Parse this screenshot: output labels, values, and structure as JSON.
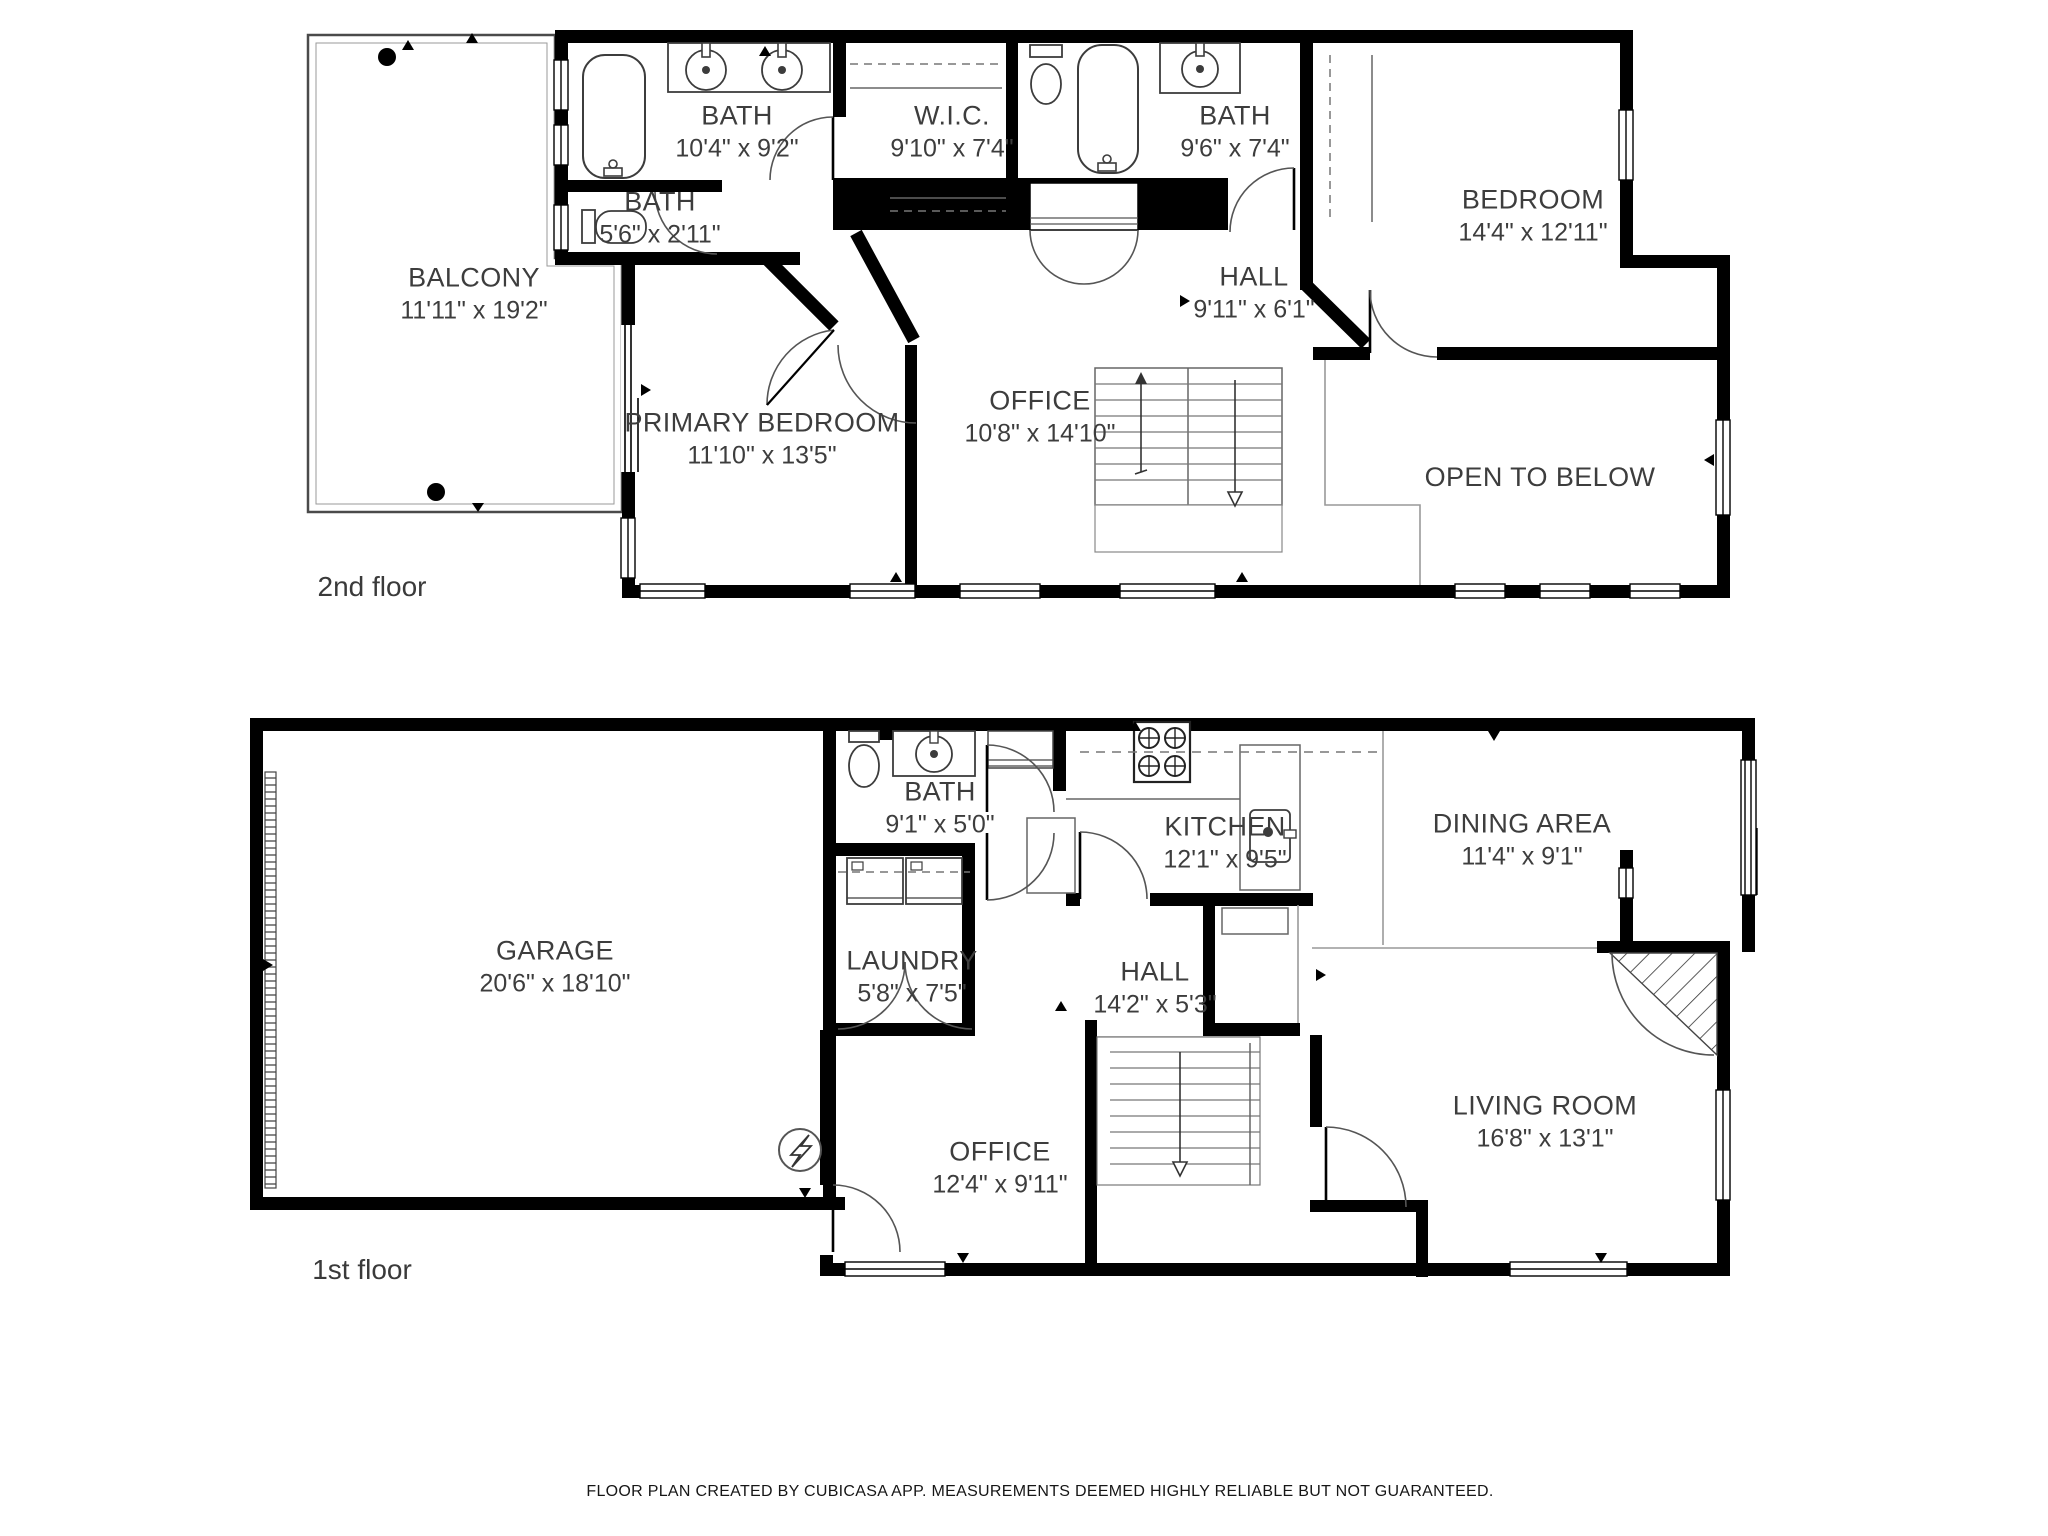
{
  "page": {
    "background": "#ffffff"
  },
  "colors": {
    "wall": "#000000",
    "fixture_line": "#444444",
    "thin_line": "#888888",
    "text": "#3d3d3d"
  },
  "floors": [
    {
      "label": "2nd floor",
      "rooms": [
        {
          "name": "BALCONY",
          "dims": "11'11\" x 19'2\""
        },
        {
          "name": "BATH",
          "dims": "10'4\" x 9'2\""
        },
        {
          "name": "BATH",
          "dims": "5'6\" x 2'11\""
        },
        {
          "name": "W.I.C.",
          "dims": "9'10\" x 7'4\""
        },
        {
          "name": "BATH",
          "dims": "9'6\" x 7'4\""
        },
        {
          "name": "BEDROOM",
          "dims": "14'4\" x 12'11\""
        },
        {
          "name": "HALL",
          "dims": "9'11\" x 6'1\""
        },
        {
          "name": "PRIMARY BEDROOM",
          "dims": "11'10\" x 13'5\""
        },
        {
          "name": "OFFICE",
          "dims": "10'8\" x 14'10\""
        },
        {
          "name": "OPEN TO BELOW",
          "dims": ""
        }
      ]
    },
    {
      "label": "1st floor",
      "rooms": [
        {
          "name": "GARAGE",
          "dims": "20'6\" x 18'10\""
        },
        {
          "name": "BATH",
          "dims": "9'1\" x 5'0\""
        },
        {
          "name": "KITCHEN",
          "dims": "12'1\" x 9'5\""
        },
        {
          "name": "DINING AREA",
          "dims": "11'4\" x 9'1\""
        },
        {
          "name": "LAUNDRY",
          "dims": "5'8\" x 7'5\""
        },
        {
          "name": "HALL",
          "dims": "14'2\" x 5'3\""
        },
        {
          "name": "OFFICE",
          "dims": "12'4\" x 9'11\""
        },
        {
          "name": "LIVING ROOM",
          "dims": "16'8\" x 13'1\""
        }
      ]
    }
  ],
  "footer": "FLOOR PLAN CREATED BY CUBICASA APP. MEASUREMENTS DEEMED HIGHLY RELIABLE BUT NOT GUARANTEED."
}
